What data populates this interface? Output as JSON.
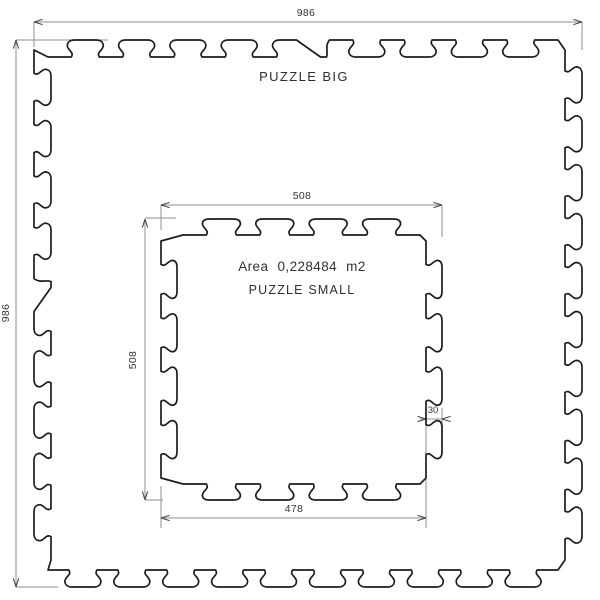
{
  "page": {
    "background": "#ffffff"
  },
  "drawing": {
    "colors": {
      "outline": "#1c1c1c",
      "dimension_line": "#8f8f8f",
      "arrow": "#4a4a4a",
      "text": "#333333"
    },
    "big_tile": {
      "label": "PUZZLE BIG",
      "width_mm": "986",
      "height_mm": "986"
    },
    "small_tile": {
      "label": "PUZZLE SMALL",
      "area_label": "Area 0,228484 m2",
      "width_mm": "508",
      "height_mm": "508",
      "bottom_width_mm": "478",
      "tooth_depth_mm": "30"
    }
  }
}
